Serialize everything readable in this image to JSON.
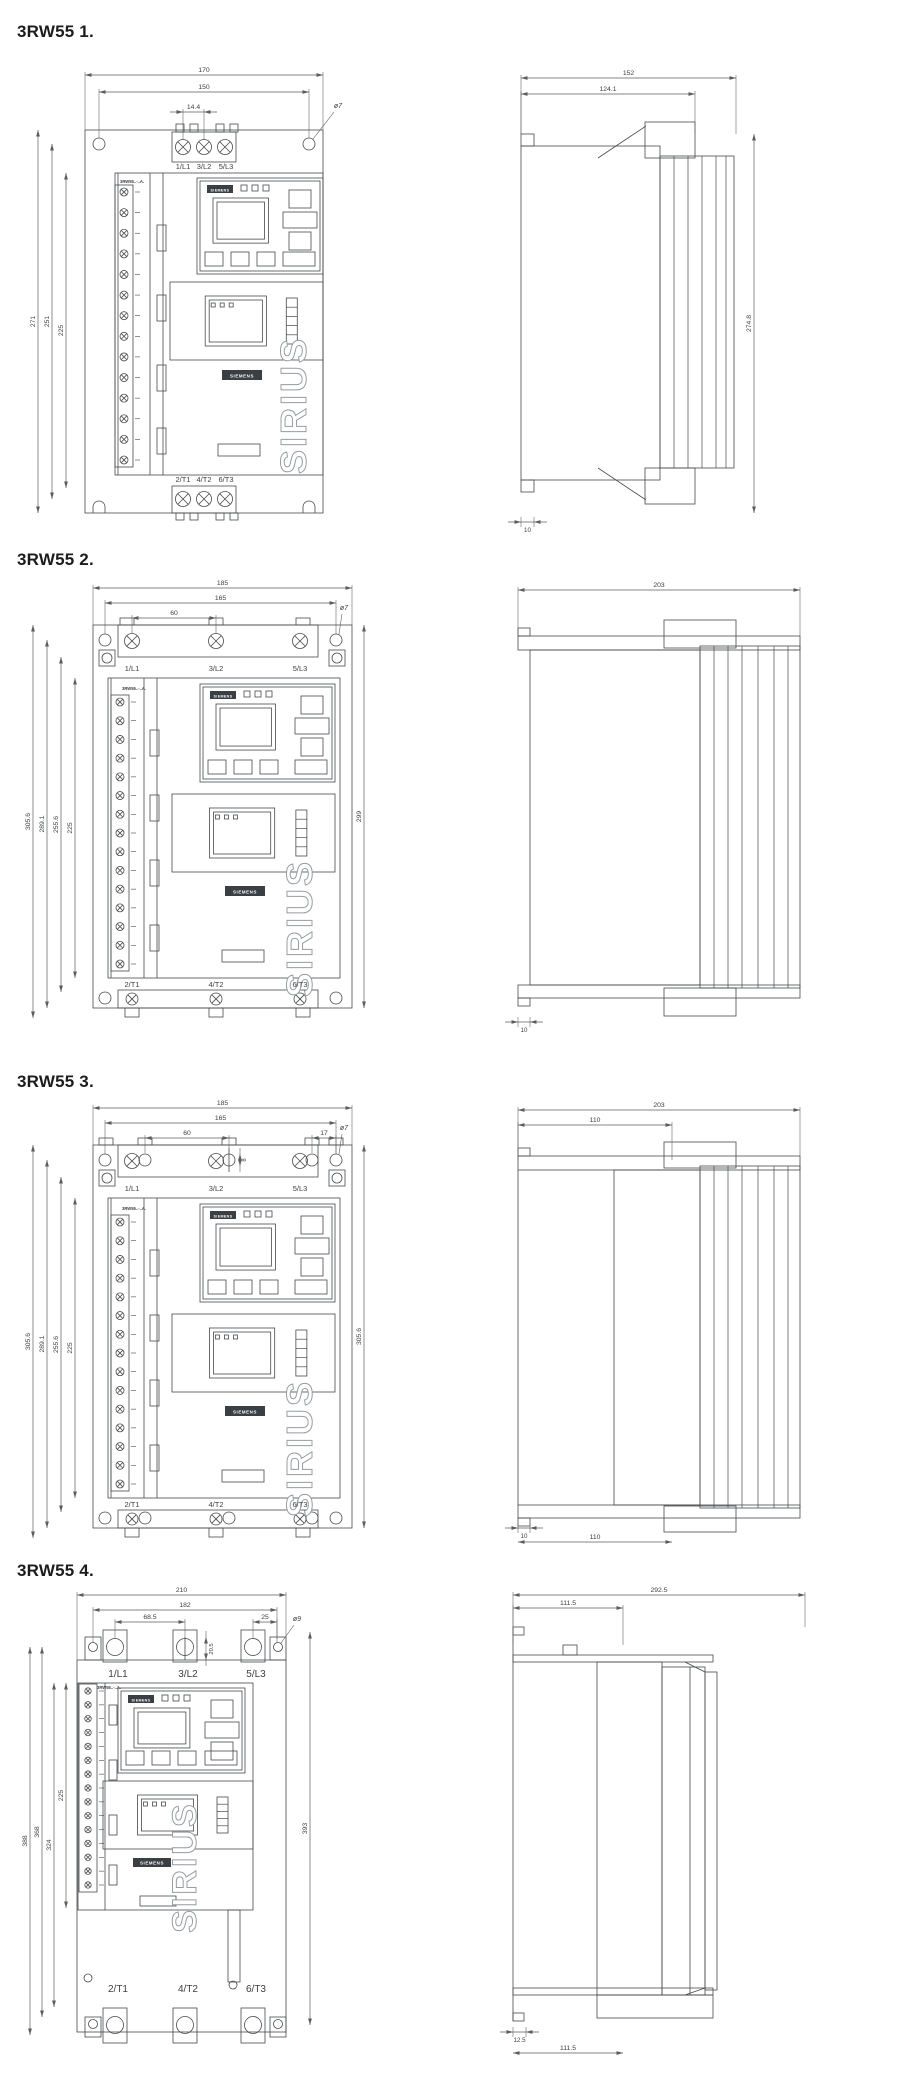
{
  "page": {
    "background": "#ffffff"
  },
  "colors": {
    "line": "#47494c",
    "dim": "#5a5c5e",
    "title": "#1c1c1c",
    "badge": "#3a3f44",
    "sirius": "#989da3",
    "text": "#3e4043"
  },
  "sections": [
    {
      "title": "3RW55 1.",
      "front": {
        "top_terminals": [
          "1/L1",
          "3/L2",
          "5/L3"
        ],
        "bottom_terminals": [
          "2/T1",
          "4/T2",
          "6/T3"
        ],
        "device_label": "3RW55..-..A.",
        "brand": "SIEMENS",
        "product_line": "SIRIUS",
        "hole_label": "ø7",
        "dims_top": [
          "170",
          "150",
          "14.4"
        ],
        "dims_left": [
          "271",
          "251",
          "225"
        ],
        "dims_right": []
      },
      "side": {
        "dims_top": [
          "152",
          "124.1"
        ],
        "dims_right": [
          "274.8"
        ],
        "dims_bottom": [
          "10"
        ]
      }
    },
    {
      "title": "3RW55 2.",
      "front": {
        "top_terminals": [
          "1/L1",
          "3/L2",
          "5/L3"
        ],
        "bottom_terminals": [
          "2/T1",
          "4/T2",
          "6/T3"
        ],
        "device_label": "3RW55..-..A.",
        "brand": "SIEMENS",
        "product_line": "SIRIUS",
        "hole_label": "ø7",
        "dims_top": [
          "185",
          "165",
          "60"
        ],
        "dims_left": [
          "305.6",
          "289.1",
          "255.6",
          "225"
        ],
        "dims_right": [
          "299"
        ]
      },
      "side": {
        "dims_top": [
          "203"
        ],
        "dims_right": [],
        "dims_bottom": [
          "10"
        ]
      }
    },
    {
      "title": "3RW55 3.",
      "front": {
        "top_terminals": [
          "1/L1",
          "3/L2",
          "5/L3"
        ],
        "bottom_terminals": [
          "2/T1",
          "4/T2",
          "6/T3"
        ],
        "device_label": "3RW55..-..A.",
        "brand": "SIEMENS",
        "product_line": "SIRIUS",
        "hole_label": "ø7",
        "dims_slot": "8",
        "dims_top": [
          "185",
          "165",
          "60",
          "17"
        ],
        "dims_left": [
          "305.6",
          "289.1",
          "255.6",
          "225"
        ],
        "dims_right": [
          "305.6"
        ]
      },
      "side": {
        "dims_top": [
          "203",
          "110"
        ],
        "dims_right": [],
        "dims_bottom": [
          "10",
          "110"
        ]
      }
    },
    {
      "title": "3RW55 4.",
      "front": {
        "top_terminals": [
          "1/L1",
          "3/L2",
          "5/L3"
        ],
        "bottom_terminals": [
          "2/T1",
          "4/T2",
          "6/T3"
        ],
        "device_label": "3RW55..-..A.",
        "brand": "SIEMENS",
        "product_line": "SIRIUS",
        "hole_label": "ø9",
        "dims_slot": "20.5",
        "dims_top": [
          "210",
          "182",
          "68.5",
          "25"
        ],
        "dims_left": [
          "388",
          "368",
          "324",
          "225"
        ],
        "dims_right": [
          "393"
        ]
      },
      "side": {
        "dims_top": [
          "292.5",
          "111.5"
        ],
        "dims_right": [],
        "dims_bottom": [
          "12.5",
          "111.5"
        ]
      }
    }
  ]
}
